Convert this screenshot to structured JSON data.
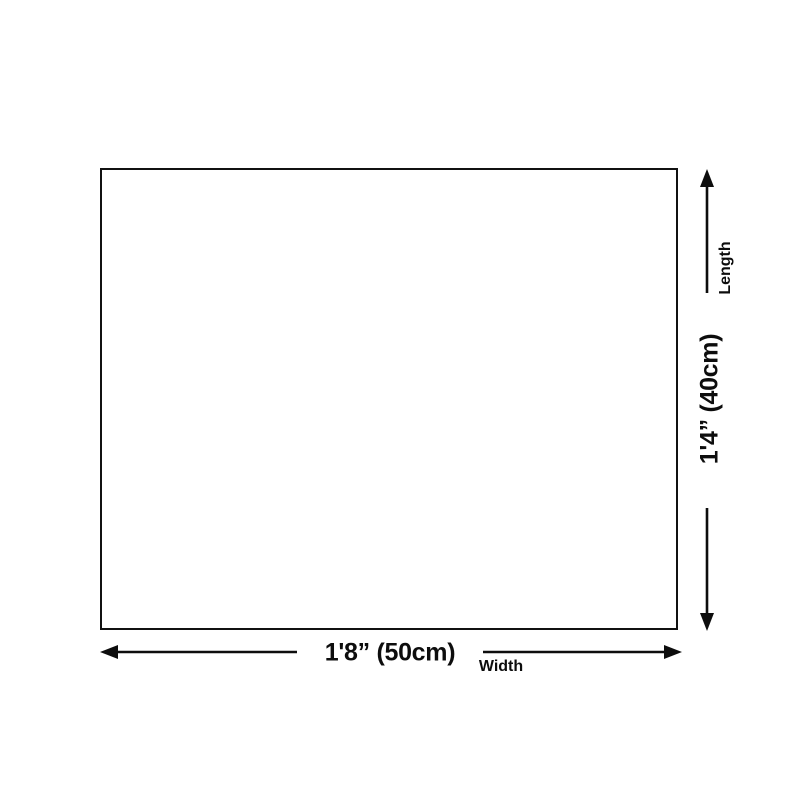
{
  "page": {
    "background_color": "#ffffff",
    "line_color": "#0d0d0d"
  },
  "diagram": {
    "type": "product-dimension-diagram",
    "shape": "rectangle-outline",
    "width_dimension": {
      "value": "1'8” (50cm)",
      "label": "Width"
    },
    "length_dimension": {
      "value": "1'4” (40cm)",
      "label": "Length"
    }
  }
}
